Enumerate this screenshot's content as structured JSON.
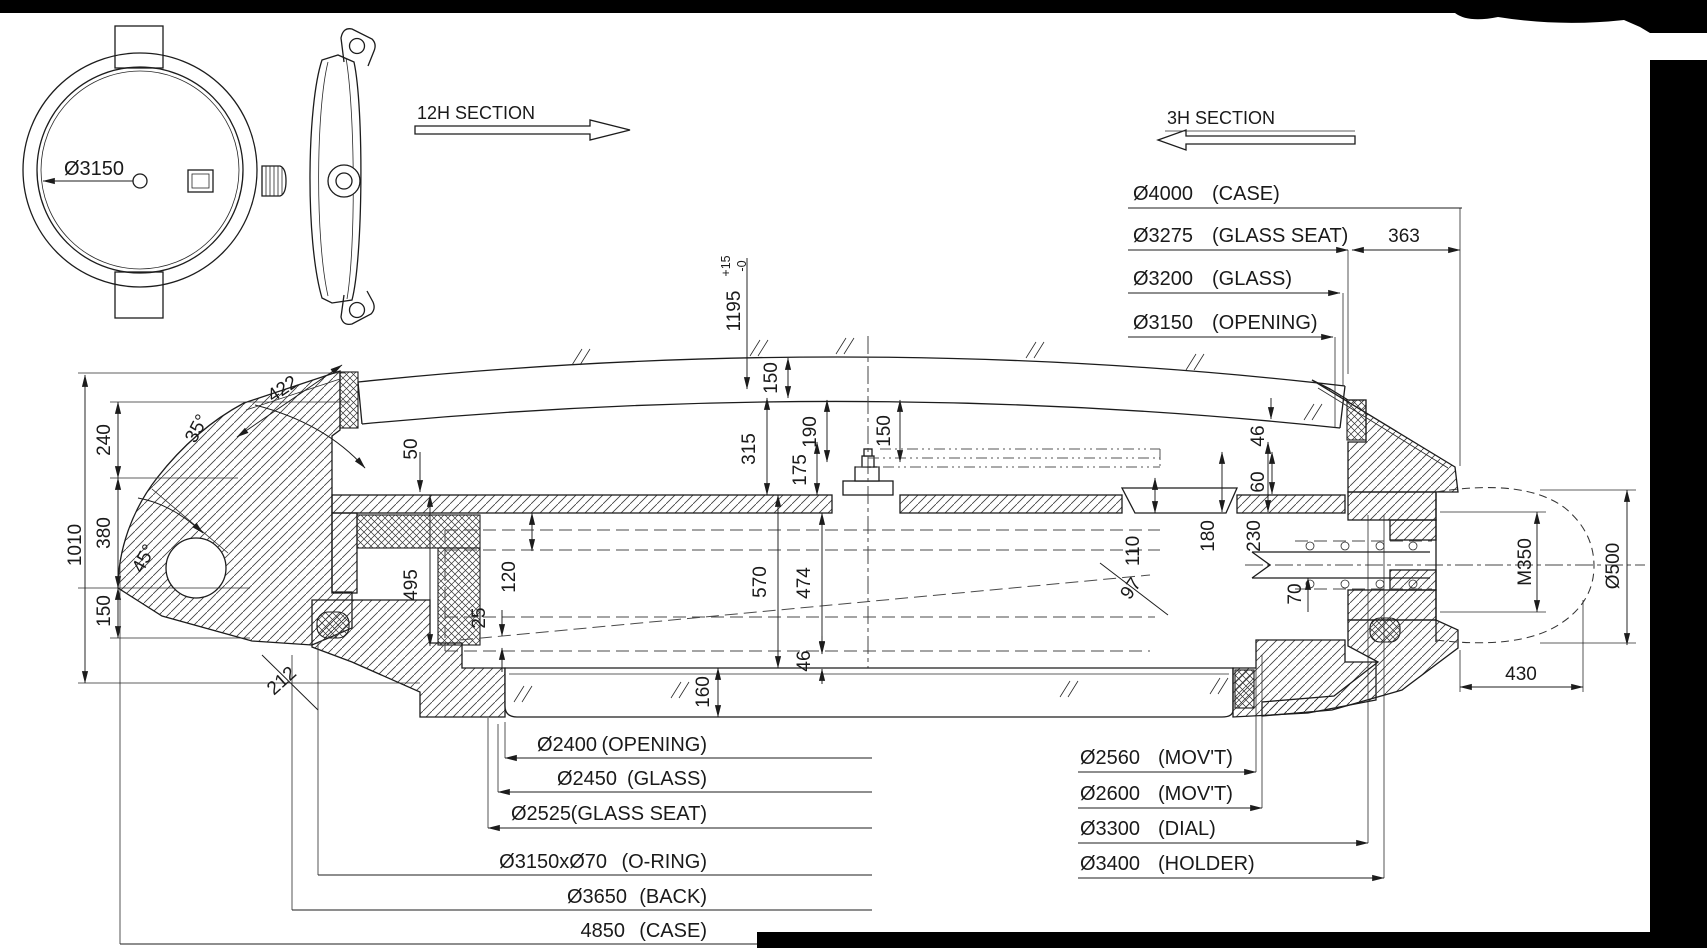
{
  "sections": {
    "left_label": "12H SECTION",
    "right_label": "3H SECTION"
  },
  "front_view": {
    "diameter_label": "Ø3150"
  },
  "callouts": {
    "top_right": [
      {
        "value": "Ø4000",
        "note": "(CASE)"
      },
      {
        "value": "Ø3275",
        "note": "(GLASS SEAT)"
      },
      {
        "value": "Ø3200",
        "note": "(GLASS)"
      },
      {
        "value": "Ø3150",
        "note": "(OPENING)"
      }
    ],
    "bottom_left": [
      {
        "value": "Ø2400",
        "note": "(OPENING)"
      },
      {
        "value": "Ø2450",
        "note": "(GLASS)"
      },
      {
        "value": "Ø2525",
        "note": "(GLASS SEAT)"
      },
      {
        "value": "Ø3150xØ70",
        "note": "(O-RING)"
      },
      {
        "value": "Ø3650",
        "note": "(BACK)"
      },
      {
        "value": "4850",
        "note": "(CASE)"
      }
    ],
    "bottom_right": [
      {
        "value": "Ø2560",
        "note": "(MOV'T)"
      },
      {
        "value": "Ø2600",
        "note": "(MOV'T)"
      },
      {
        "value": "Ø3300",
        "note": "(DIAL)"
      },
      {
        "value": "Ø3400",
        "note": "(HOLDER)"
      }
    ]
  },
  "dims": {
    "d1010": "1010",
    "d240": "240",
    "d380": "380",
    "d150_left": "150",
    "a35": "35°",
    "a45": "45°",
    "d422": "422",
    "d212": "212",
    "d50": "50",
    "d495": "495",
    "d120": "120",
    "d25": "25",
    "d160": "160",
    "d570": "570",
    "d474": "474",
    "d46_back": "46",
    "d315": "315",
    "d150_glass": "150",
    "d190": "190",
    "d175": "175",
    "d150_hands": "150",
    "d1195": "1195",
    "d1195_tol_up": "+15",
    "d1195_tol_dn": "-0",
    "d110": "110",
    "d97": "97",
    "d46_right": "46",
    "d60": "60",
    "d180": "180",
    "d230": "230",
    "d70": "70",
    "dM350": "M350",
    "dD500": "Ø500",
    "d430": "430",
    "d363": "363"
  }
}
